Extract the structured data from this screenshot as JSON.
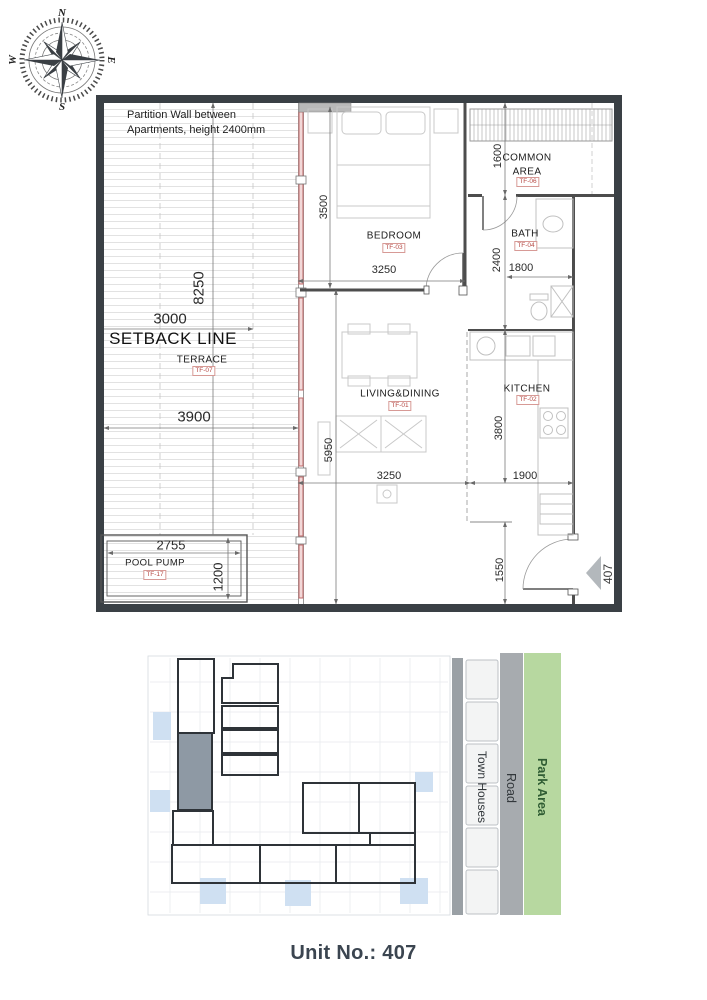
{
  "page_title": "Unit No.: 407",
  "unit_number": "407",
  "compass": {
    "north": "N",
    "east": "E",
    "south": "S",
    "west": "W"
  },
  "notes": {
    "partition_wall": "Partition Wall between Apartments, height 2400mm",
    "setback_line": "SETBACK LINE"
  },
  "rooms": {
    "bedroom": {
      "name": "BEDROOM",
      "code": "TF-03"
    },
    "common_area": {
      "name": "COMMON AREA",
      "code": "TF-06"
    },
    "bath": {
      "name": "BATH",
      "code": "TF-04"
    },
    "living_dining": {
      "name": "LIVING&DINING",
      "code": "TF-01"
    },
    "kitchen": {
      "name": "KITCHEN",
      "code": "TF-02"
    },
    "terrace": {
      "name": "TERRACE",
      "code": "TF-07"
    },
    "pool_pump": {
      "name": "POOL PUMP",
      "code": "TF-17"
    }
  },
  "dimensions": {
    "bedroom_depth": "3500",
    "bedroom_width": "3250",
    "common_depth": "1600",
    "bath_depth": "2400",
    "bath_width": "1800",
    "terrace_length": "8250",
    "setback_offset": "3000",
    "terrace_width": "3900",
    "living_depth": "5950",
    "living_width": "3250",
    "kitchen_depth": "3800",
    "kitchen_width": "1900",
    "pool_pump_width": "2755",
    "pool_pump_depth": "1200",
    "entry_depth": "1550"
  },
  "site": {
    "town_houses": "Town Houses",
    "road": "Road",
    "park_area": "Park Area"
  },
  "colors": {
    "wall_dark": "#3a4045",
    "partition_red": "#c06868",
    "highlight_unit": "#8e99a4",
    "park_green": "#b7d8a0",
    "road_gray": "#a7abaf",
    "site_blue": "#cfe0f2"
  }
}
